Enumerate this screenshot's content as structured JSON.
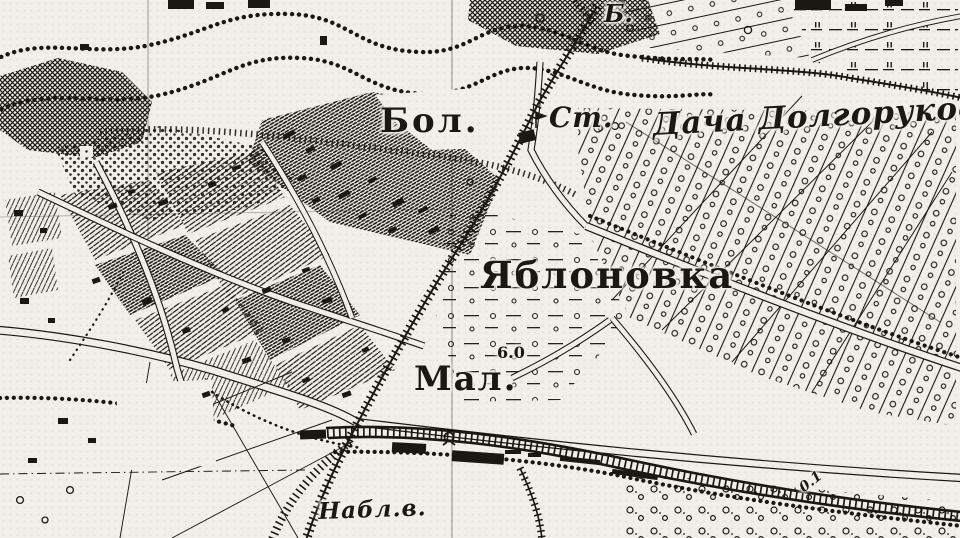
{
  "map": {
    "colors": {
      "paper": "#f1efe9",
      "ink": "#1b1713"
    },
    "labels": [
      {
        "id": "b-abbrev",
        "text": "Б.",
        "x": 604,
        "y": 2,
        "size": 24,
        "weight": 700,
        "italic": true,
        "rotation": 0,
        "letter_spacing": 0
      },
      {
        "id": "bol",
        "text": "Бол.",
        "x": 380,
        "y": 104,
        "size": 34,
        "weight": 700,
        "italic": false,
        "rotation": 0,
        "letter_spacing": 3
      },
      {
        "id": "station",
        "text": "Ст.",
        "x": 549,
        "y": 104,
        "size": 28,
        "weight": 700,
        "italic": true,
        "rotation": 0,
        "letter_spacing": 1
      },
      {
        "id": "dacha",
        "text": "Дача Долгорукова",
        "x": 652,
        "y": 110,
        "size": 31,
        "weight": 700,
        "italic": true,
        "rotation": -3,
        "letter_spacing": 1
      },
      {
        "id": "yablonovka",
        "text": "Яблоновка",
        "x": 480,
        "y": 257,
        "size": 37,
        "weight": 700,
        "italic": false,
        "rotation": 0,
        "letter_spacing": 2
      },
      {
        "id": "mal",
        "text": "Мал.",
        "x": 414,
        "y": 362,
        "size": 34,
        "weight": 700,
        "italic": false,
        "rotation": 0,
        "letter_spacing": 2
      },
      {
        "id": "elevation-6-0",
        "text": "6.0",
        "x": 497,
        "y": 345,
        "size": 16,
        "weight": 700,
        "italic": false,
        "rotation": 0,
        "letter_spacing": 0
      },
      {
        "id": "nabl-v",
        "text": "Набл.в.",
        "x": 318,
        "y": 500,
        "size": 23,
        "weight": 700,
        "italic": true,
        "rotation": -2,
        "letter_spacing": 1
      },
      {
        "id": "dim-0-1",
        "text": "0.1",
        "x": 797,
        "y": 484,
        "size": 14,
        "weight": 700,
        "italic": true,
        "rotation": -38,
        "letter_spacing": 0
      }
    ]
  }
}
